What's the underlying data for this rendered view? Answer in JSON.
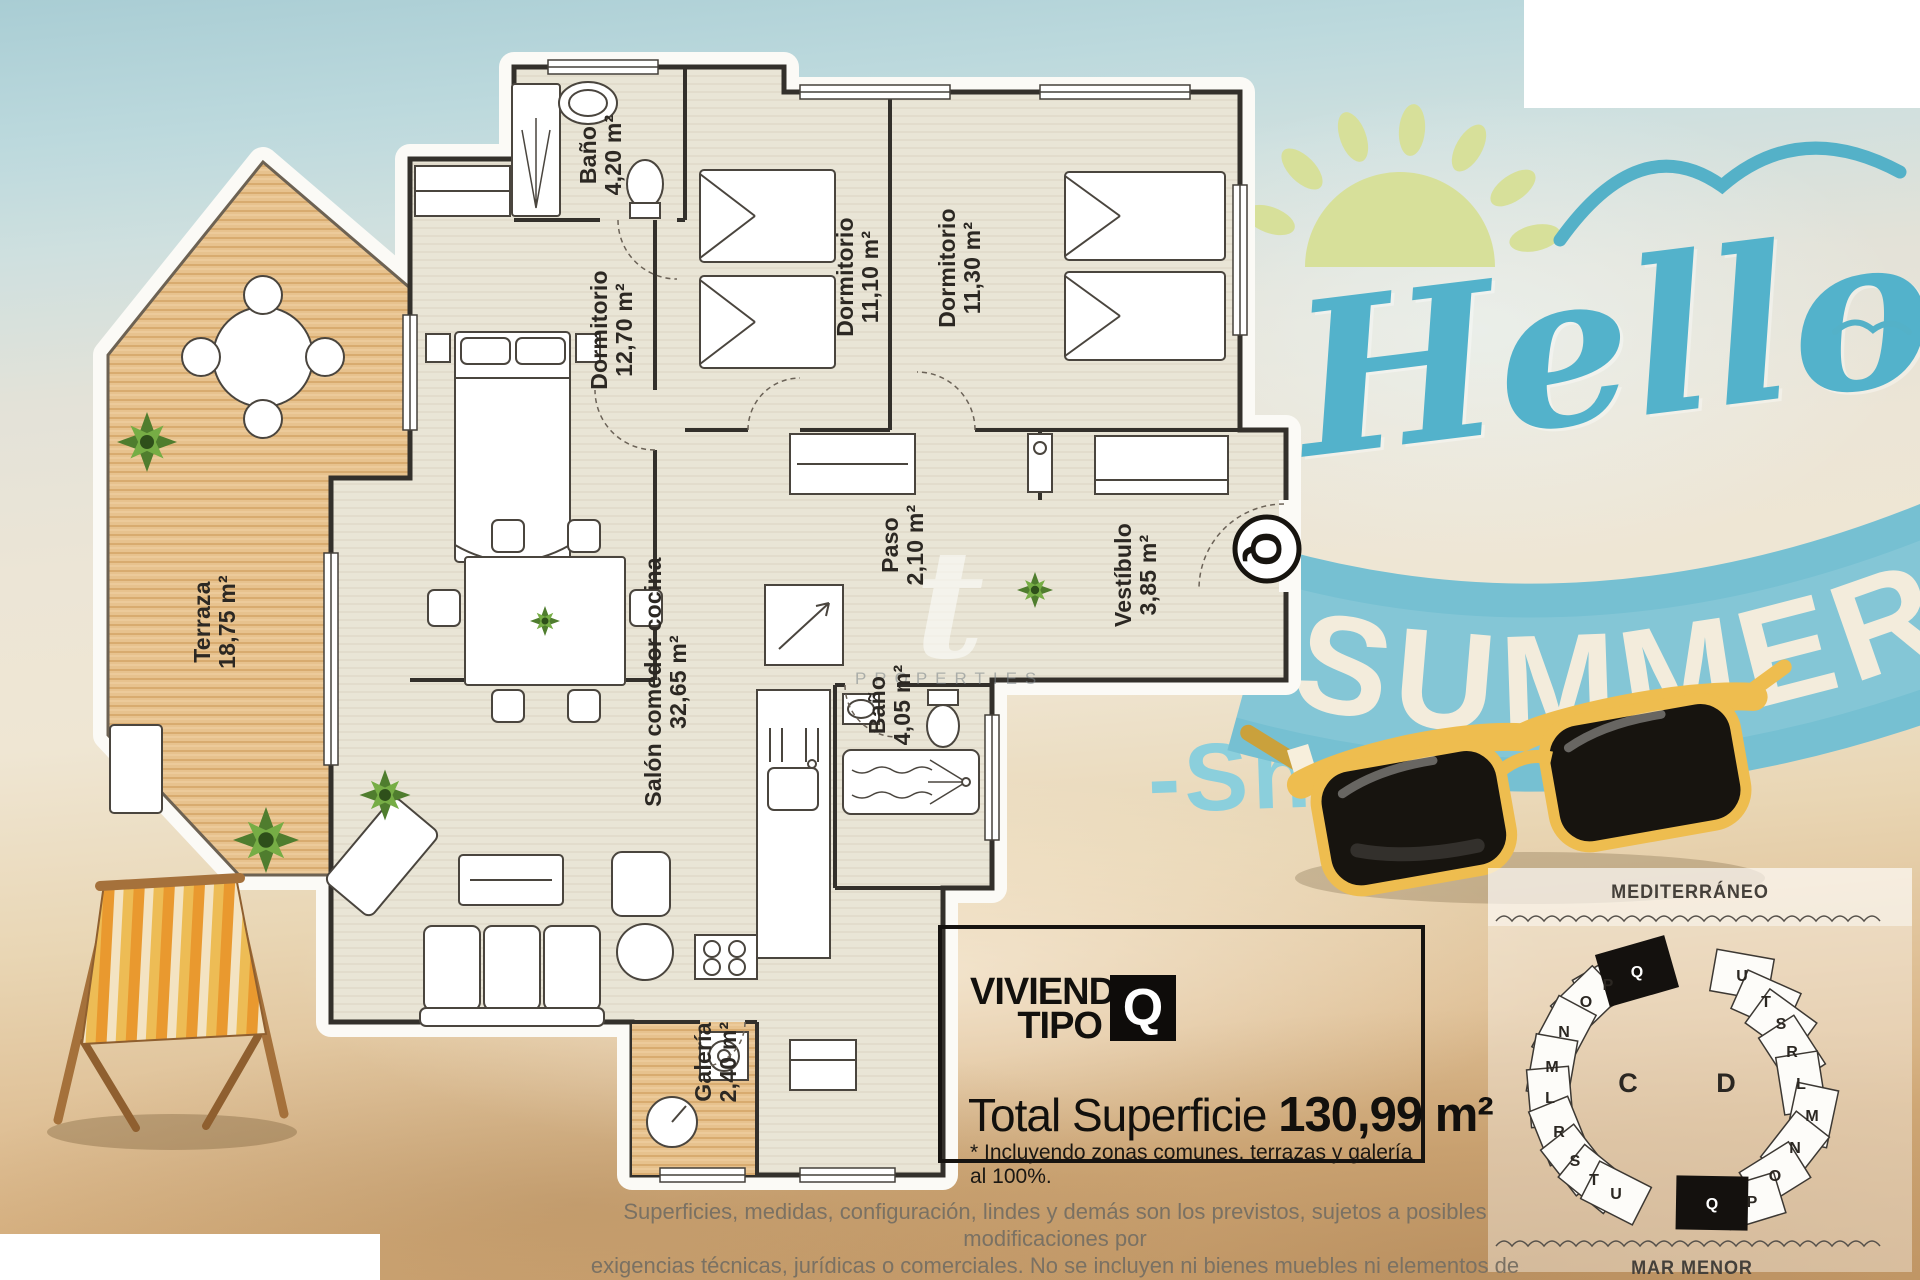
{
  "plan": {
    "rooms": [
      {
        "name": "Baño",
        "area": "4,20 m²"
      },
      {
        "name": "Dormitorio",
        "area": "12,70 m²"
      },
      {
        "name": "Dormitorio",
        "area": "11,10 m²"
      },
      {
        "name": "Dormitorio",
        "area": "11,30 m²"
      },
      {
        "name": "Paso",
        "area": "2,10 m²"
      },
      {
        "name": "Vestíbulo",
        "area": "3,85 m²"
      },
      {
        "name": "Baño",
        "area": "4,05 m²"
      },
      {
        "name": "Salón comedor cocina",
        "area": "32,65 m²"
      },
      {
        "name": "Terraza",
        "area": "18,75 m²"
      },
      {
        "name": "Galería",
        "area": "2,40 m²"
      }
    ],
    "entrance_badge": "Q"
  },
  "promo": {
    "hello": "Hello",
    "summer": "SUMMER",
    "shine": "-Shi"
  },
  "watermark": {
    "glyph": "t",
    "text": "PROPERTIES"
  },
  "info_box": {
    "line1": "VIVIENDA",
    "line2": "TIPO",
    "unit": "Q",
    "total_label": "Total Superficie ",
    "total_value": "130,99 m²",
    "note": "* Incluyendo zonas comunes, terrazas y galería al 100%."
  },
  "site_map": {
    "sea_top": "MEDITERRÁNEO",
    "sea_bottom": "MAR MENOR",
    "block_c_label": "C",
    "block_d_label": "D",
    "block_c_units": [
      "P",
      "Q",
      "O",
      "N",
      "M",
      "L",
      "R",
      "S",
      "T",
      "U"
    ],
    "block_d_units": [
      "U",
      "T",
      "S",
      "R",
      "L",
      "M",
      "N",
      "O",
      "Q",
      "P"
    ]
  },
  "disclaimer": {
    "line1": "Superficies, medidas, configuración, lindes y demás son los previstos, sujetos a posibles modificaciones por",
    "line2": "exigencias técnicas, jurídicas o comerciales. No se incluyen ni bienes muebles ni elementos de jardinería."
  },
  "colors": {
    "hello_blue": "#53b2cb",
    "ribbon_blue": "#76c0d2",
    "sun_green": "#d7e09a",
    "sunglasses_yellow": "#eebd4f",
    "wood": "#e7c28e",
    "floor": "#e9e5d6"
  }
}
